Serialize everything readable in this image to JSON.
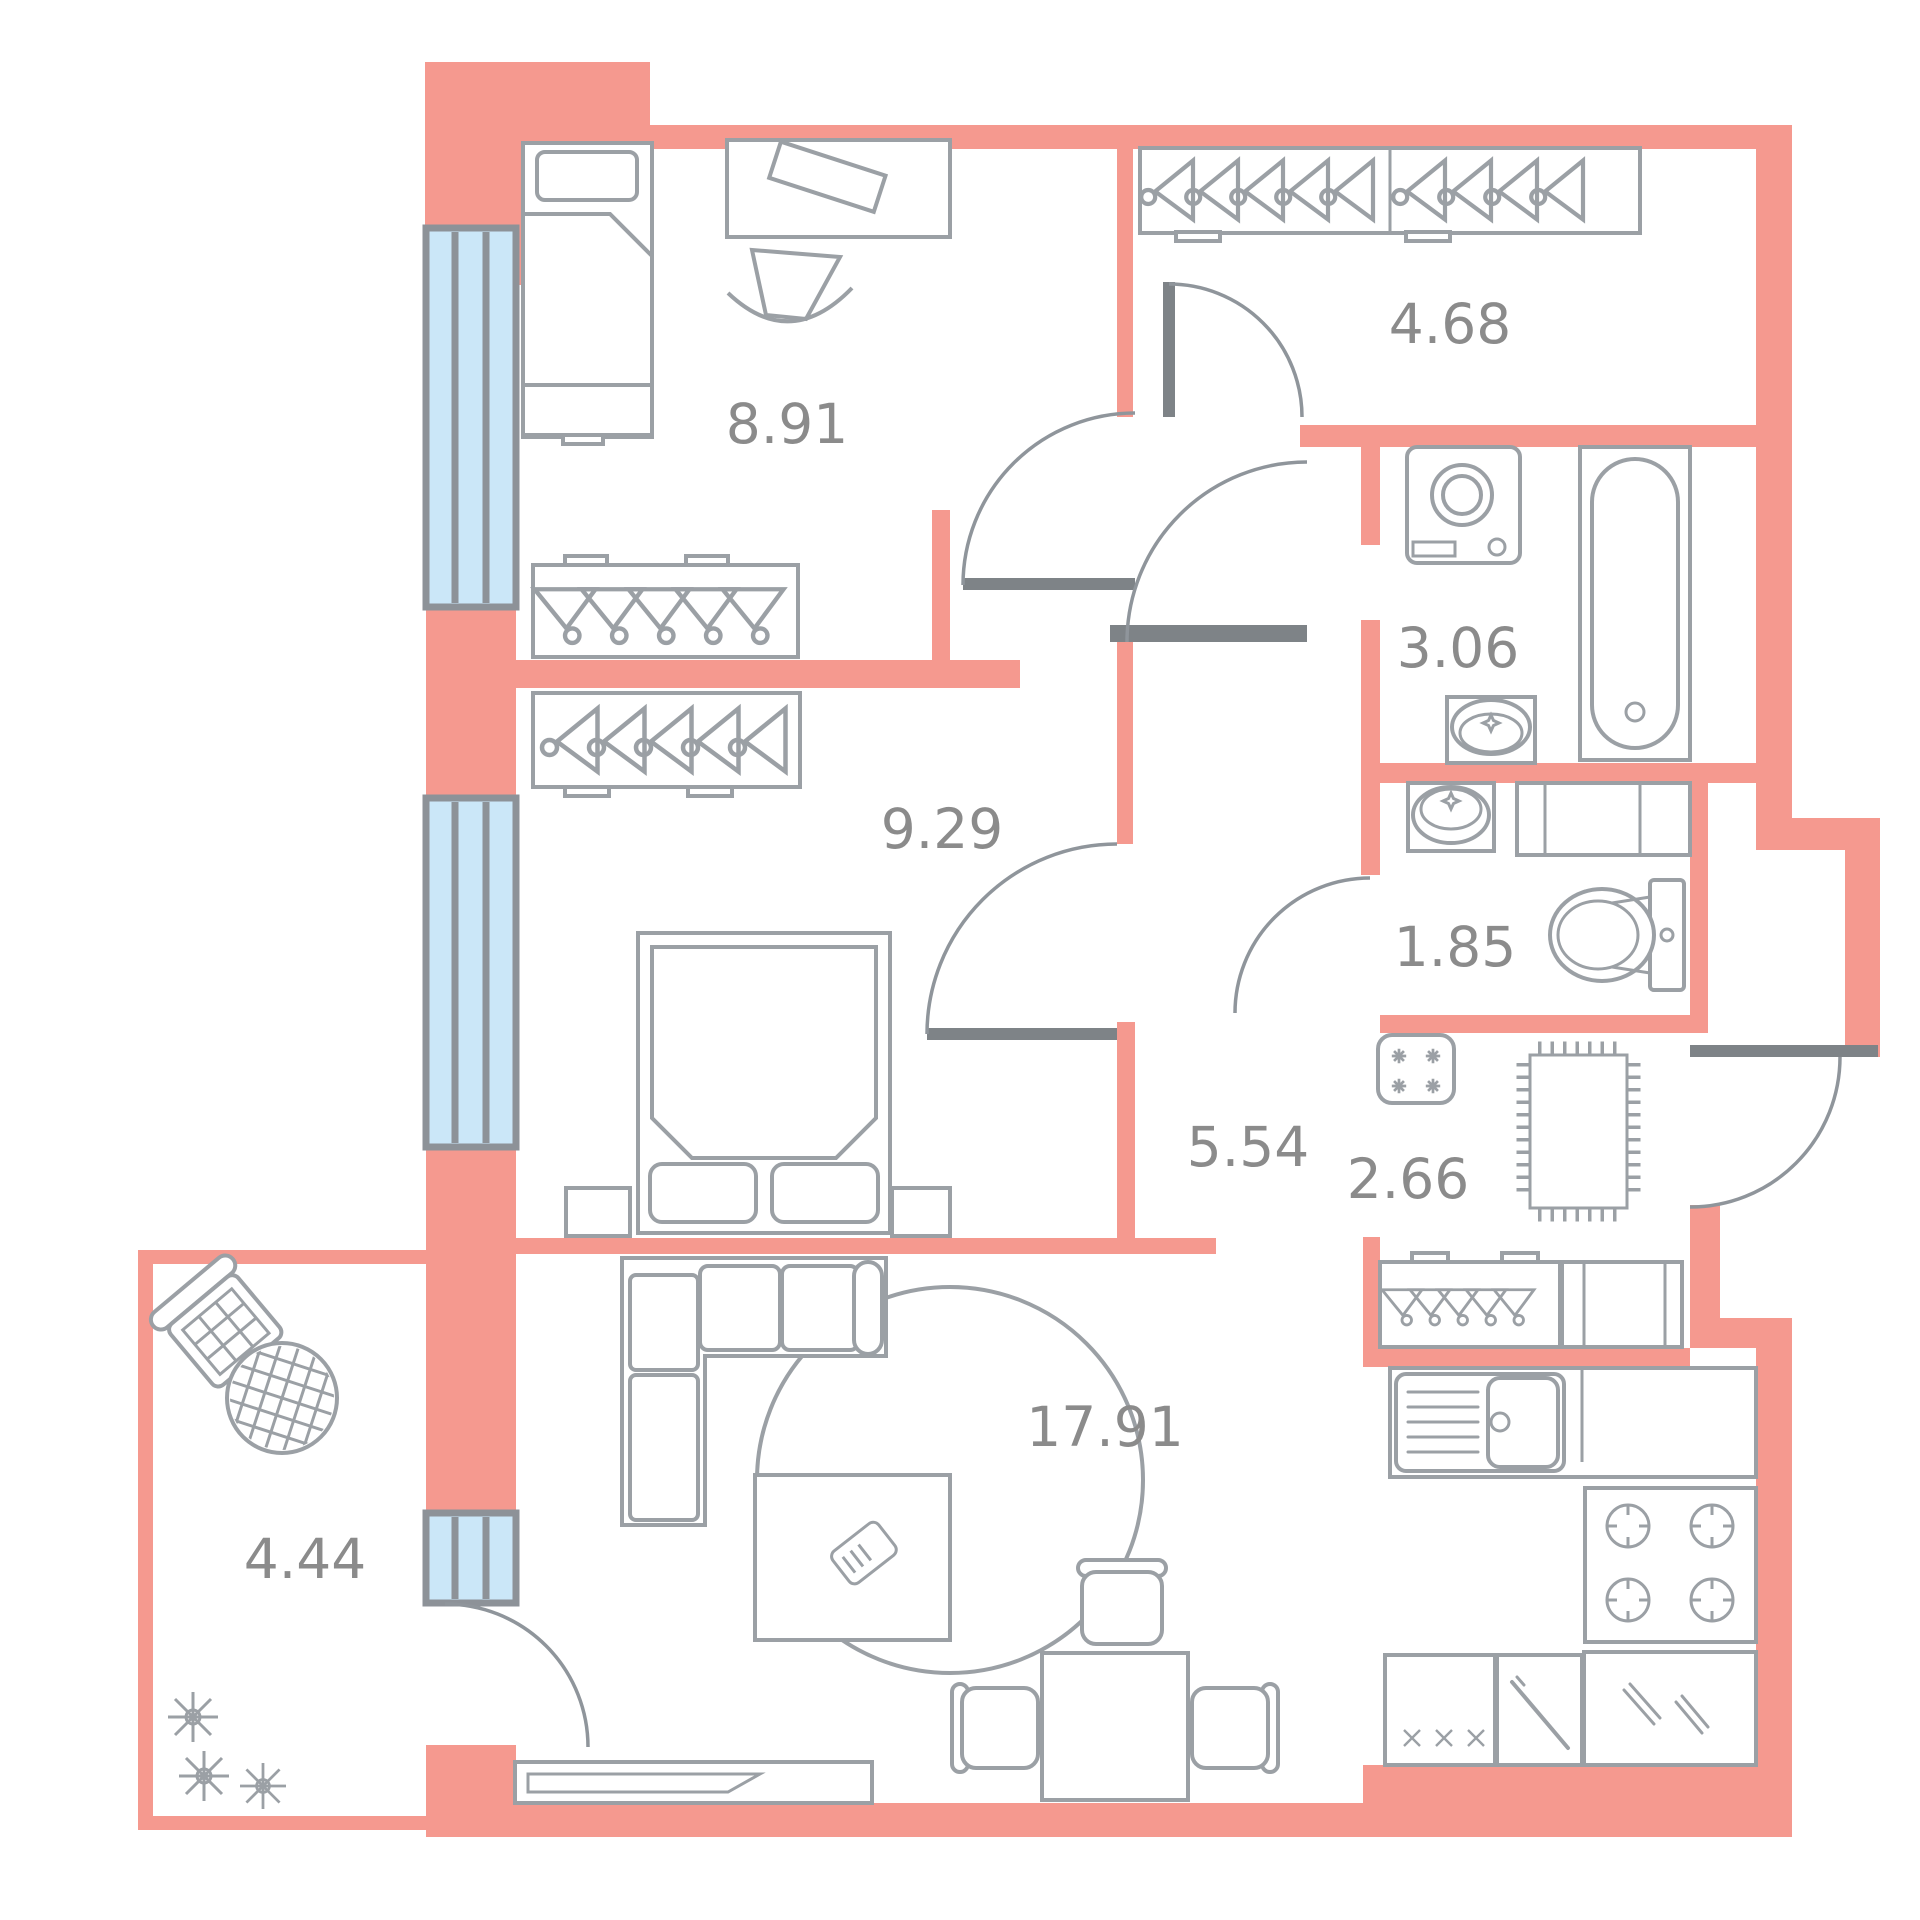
{
  "floorplan": {
    "rooms": [
      {
        "name": "bedroom-1",
        "area": "8.91",
        "fixtures": [
          "single-bed",
          "desk",
          "desk-chair",
          "wardrobe-hangers",
          "window"
        ]
      },
      {
        "name": "wardrobe-hall",
        "area": "4.68",
        "fixtures": [
          "wardrobe-hangers"
        ]
      },
      {
        "name": "bathroom",
        "area": "3.06",
        "fixtures": [
          "washing-machine",
          "bathtub",
          "sink"
        ]
      },
      {
        "name": "bedroom-2",
        "area": "9.29",
        "fixtures": [
          "double-bed",
          "nightstands",
          "wardrobe-hangers",
          "window"
        ]
      },
      {
        "name": "toilet",
        "area": "1.85",
        "fixtures": [
          "sink",
          "counter",
          "toilet"
        ]
      },
      {
        "name": "corridor",
        "area": "5.54",
        "fixtures": []
      },
      {
        "name": "entry-hall",
        "area": "2.66",
        "fixtures": [
          "asterisk-panel",
          "doormat",
          "wardrobe-hangers",
          "shoe-cabinet",
          "entrance-door"
        ]
      },
      {
        "name": "living-room-kitchen",
        "area": "17.91",
        "fixtures": [
          "corner-sofa",
          "round-rug",
          "coffee-table",
          "tv-stand",
          "dining-table",
          "chairs",
          "kitchen-sink-counter",
          "stove",
          "base-cabinets"
        ]
      },
      {
        "name": "balcony",
        "area": "4.44",
        "fixtures": [
          "armchair",
          "round-table",
          "plants"
        ]
      }
    ],
    "colors": {
      "wall": "#F5998F",
      "window_fill": "#CBE7F8",
      "window_frame": "#8D9298",
      "furniture_line": "#9BA0A5",
      "door_dark": "#7E8387",
      "label_text": "#8B8B8B",
      "background": "#FFFFFF"
    }
  }
}
